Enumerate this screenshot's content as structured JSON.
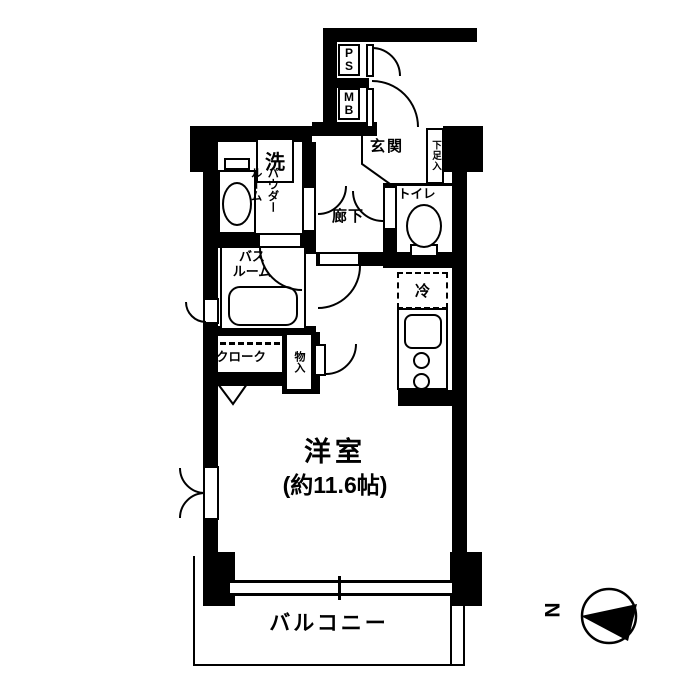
{
  "floor_plan": {
    "background_color": "#ffffff",
    "wall_color": "#000000",
    "labels": {
      "pipe_space": "PS",
      "meter_box": "MB",
      "entrance": "玄関",
      "shoe_cabinet": "下足入",
      "hallway": "廊下",
      "toilet": "トイレ",
      "washer": "洗",
      "powder_room": "パウダー\nルーム",
      "bathroom": "バス\nルーム",
      "cloak": "クローク",
      "storage": "物入",
      "refrigerator": "冷",
      "main_room": "洋室",
      "main_room_size": "(約11.6帖)",
      "balcony": "バルコニー"
    },
    "compass": {
      "north_label": "N"
    }
  }
}
